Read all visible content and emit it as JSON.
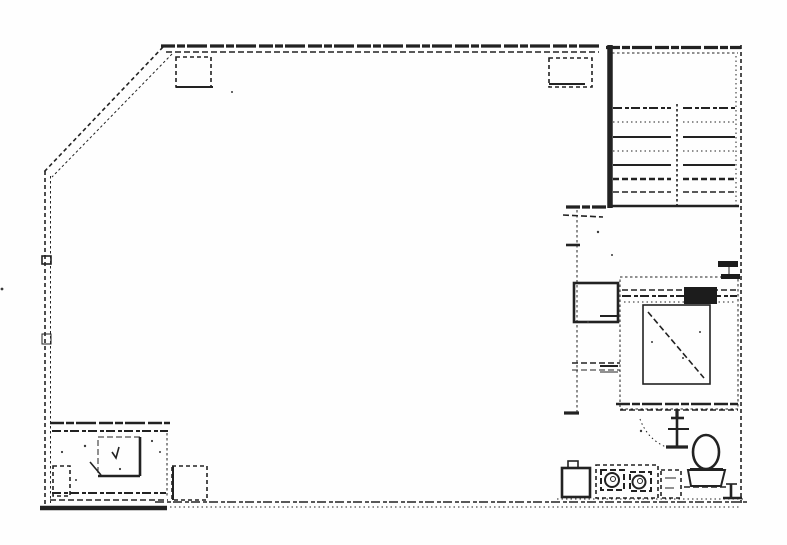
{
  "colors": {
    "ink": "#222222",
    "paper": "#fefefe"
  },
  "canvas": {
    "width": 787,
    "height": 545
  },
  "plan": {
    "elements": [
      {
        "name": "top-wall-outer",
        "t": "line",
        "x1": 161,
        "y1": 46,
        "x2": 601,
        "y2": 46,
        "cls": "w3 rough"
      },
      {
        "name": "top-wall-inner",
        "t": "line",
        "x1": 166,
        "y1": 52,
        "x2": 599,
        "y2": 52,
        "cls": "w15 dashA"
      },
      {
        "name": "chamfer-wall-outer",
        "t": "line",
        "x1": 163,
        "y1": 47,
        "x2": 44,
        "y2": 172,
        "cls": "w15 dashB"
      },
      {
        "name": "chamfer-wall-inner",
        "t": "line",
        "x1": 172,
        "y1": 54,
        "x2": 52,
        "y2": 177,
        "cls": "w1 dashC"
      },
      {
        "name": "left-wall-outer",
        "t": "line",
        "x1": 45,
        "y1": 171,
        "x2": 45,
        "y2": 509,
        "cls": "w15 dashB"
      },
      {
        "name": "left-wall-inner",
        "t": "line",
        "x1": 50.5,
        "y1": 176,
        "x2": 50.5,
        "y2": 503,
        "cls": "w1 dashC"
      },
      {
        "name": "left-wall-joint-upper",
        "t": "rect",
        "x": 42,
        "y": 256,
        "w": 9,
        "h": 8,
        "cls": "w15"
      },
      {
        "name": "left-wall-joint-lower",
        "t": "rect",
        "x": 42,
        "y": 334,
        "w": 9,
        "h": 10,
        "cls": "w1"
      },
      {
        "name": "bottom-wall-left-solid",
        "t": "line",
        "x1": 40,
        "y1": 508,
        "x2": 167,
        "y2": 508,
        "cls": "w4"
      },
      {
        "name": "bottom-wall-dashed",
        "t": "line",
        "x1": 155,
        "y1": 502,
        "x2": 748,
        "y2": 502,
        "cls": "w15 dashRough"
      },
      {
        "name": "bottom-wall-dotted",
        "t": "line",
        "x1": 170,
        "y1": 507,
        "x2": 740,
        "y2": 507,
        "cls": "w1 dotted"
      },
      {
        "name": "right-wall-dashed",
        "t": "line",
        "x1": 741,
        "y1": 45,
        "x2": 741,
        "y2": 503,
        "cls": "w15 dashB"
      },
      {
        "name": "stair-left-wall",
        "t": "line",
        "x1": 610,
        "y1": 45,
        "x2": 610,
        "y2": 208,
        "cls": "w5"
      },
      {
        "name": "stair-top-wall-outer",
        "t": "line",
        "x1": 606,
        "y1": 47.5,
        "x2": 741,
        "y2": 47.5,
        "cls": "w3 rough"
      },
      {
        "name": "stair-top-wall-inner",
        "t": "line",
        "x1": 612,
        "y1": 53,
        "x2": 738,
        "y2": 53,
        "cls": "w1 dashC"
      },
      {
        "name": "stair-right-inner-line",
        "t": "line",
        "x1": 736,
        "y1": 56,
        "x2": 736,
        "y2": 205,
        "cls": "w1 dotted"
      },
      {
        "name": "stair-bottom-wall",
        "t": "line",
        "x1": 608,
        "y1": 206,
        "x2": 739,
        "y2": 206,
        "cls": "w25"
      },
      {
        "name": "stair-center-divider",
        "t": "line",
        "x1": 677,
        "y1": 104,
        "x2": 677,
        "y2": 205,
        "cls": "w15 dashC"
      },
      {
        "name": "stair-tread",
        "t": "line",
        "x1": 613,
        "y1": 108,
        "x2": 671,
        "y2": 108,
        "cls": "w2 dashRough"
      },
      {
        "name": "stair-tread",
        "t": "line",
        "x1": 683,
        "y1": 108,
        "x2": 735,
        "y2": 108,
        "cls": "w2 dashRough"
      },
      {
        "name": "stair-tread",
        "t": "line",
        "x1": 613,
        "y1": 122,
        "x2": 671,
        "y2": 122,
        "cls": "w1 dotted"
      },
      {
        "name": "stair-tread",
        "t": "line",
        "x1": 683,
        "y1": 122,
        "x2": 735,
        "y2": 122,
        "cls": "w1 dotted"
      },
      {
        "name": "stair-tread",
        "t": "line",
        "x1": 613,
        "y1": 137,
        "x2": 671,
        "y2": 137,
        "cls": "w2"
      },
      {
        "name": "stair-tread",
        "t": "line",
        "x1": 683,
        "y1": 137,
        "x2": 735,
        "y2": 137,
        "cls": "w2"
      },
      {
        "name": "stair-tread",
        "t": "line",
        "x1": 613,
        "y1": 151,
        "x2": 671,
        "y2": 151,
        "cls": "w1 dotted"
      },
      {
        "name": "stair-tread",
        "t": "line",
        "x1": 683,
        "y1": 151,
        "x2": 735,
        "y2": 151,
        "cls": "w1 dotted"
      },
      {
        "name": "stair-tread",
        "t": "line",
        "x1": 613,
        "y1": 165,
        "x2": 671,
        "y2": 165,
        "cls": "w2"
      },
      {
        "name": "stair-tread",
        "t": "line",
        "x1": 683,
        "y1": 165,
        "x2": 735,
        "y2": 165,
        "cls": "w2"
      },
      {
        "name": "stair-tread",
        "t": "line",
        "x1": 613,
        "y1": 179,
        "x2": 671,
        "y2": 179,
        "cls": "w25 dashA"
      },
      {
        "name": "stair-tread",
        "t": "line",
        "x1": 683,
        "y1": 179,
        "x2": 735,
        "y2": 179,
        "cls": "w25 dashA"
      },
      {
        "name": "stair-tread",
        "t": "line",
        "x1": 613,
        "y1": 192,
        "x2": 671,
        "y2": 192,
        "cls": "w15 dashA"
      },
      {
        "name": "stair-tread",
        "t": "line",
        "x1": 683,
        "y1": 192,
        "x2": 735,
        "y2": 192,
        "cls": "w15 dashA"
      },
      {
        "name": "stair-landing-stub",
        "t": "line",
        "x1": 566,
        "y1": 207,
        "x2": 606,
        "y2": 207,
        "cls": "w3 rough"
      },
      {
        "name": "stair-landing-stub-lower",
        "t": "line",
        "x1": 563,
        "y1": 215,
        "x2": 603,
        "y2": 217,
        "cls": "w15 dashA"
      },
      {
        "name": "lobby-dashed-wall",
        "t": "line",
        "x1": 577,
        "y1": 210,
        "x2": 577,
        "y2": 414,
        "cls": "w1 dashC"
      },
      {
        "name": "lobby-wall-tick",
        "t": "line",
        "x1": 566,
        "y1": 245,
        "x2": 580,
        "y2": 245,
        "cls": "w25"
      },
      {
        "name": "lobby-wall-foot",
        "t": "line",
        "x1": 564,
        "y1": 413,
        "x2": 579,
        "y2": 413,
        "cls": "w3"
      },
      {
        "name": "column-top-left",
        "t": "rect",
        "x": 176,
        "y": 57,
        "w": 35,
        "h": 30,
        "cls": "w15 dashB"
      },
      {
        "name": "column-top-left-base",
        "t": "line",
        "x1": 176,
        "y1": 87,
        "x2": 213,
        "y2": 87,
        "cls": "w2"
      },
      {
        "name": "column-top-right",
        "t": "rect",
        "x": 549,
        "y": 58,
        "w": 43,
        "h": 29,
        "cls": "w15 dashB"
      },
      {
        "name": "column-top-right-base",
        "t": "line",
        "x1": 549,
        "y1": 84,
        "x2": 585,
        "y2": 84,
        "cls": "w2"
      },
      {
        "name": "column-bottom-middle",
        "t": "rect",
        "x": 172,
        "y": 466,
        "w": 35,
        "h": 34,
        "cls": "w15 dashB"
      },
      {
        "name": "column-bottom-middle-edge",
        "t": "line",
        "x1": 173,
        "y1": 466,
        "x2": 173,
        "y2": 500,
        "cls": "w2"
      },
      {
        "name": "utility-shaft-box",
        "t": "rect",
        "x": 574,
        "y": 283,
        "w": 44,
        "h": 39,
        "cls": "w25"
      },
      {
        "name": "elevator-shaft-outline",
        "t": "rect",
        "x": 620,
        "y": 277,
        "w": 118,
        "h": 132,
        "cls": "w1 dashC"
      },
      {
        "name": "elevator-door-line-1",
        "t": "line",
        "x1": 622,
        "y1": 290,
        "x2": 737,
        "y2": 290,
        "cls": "w15 dashA"
      },
      {
        "name": "elevator-door-line-2",
        "t": "line",
        "x1": 622,
        "y1": 296,
        "x2": 737,
        "y2": 296,
        "cls": "w2 dashRough"
      },
      {
        "name": "elevator-door-line-3",
        "t": "line",
        "x1": 624,
        "y1": 302,
        "x2": 735,
        "y2": 302,
        "cls": "w1 dotted"
      },
      {
        "name": "elevator-door-hatch",
        "t": "rect",
        "x": 684,
        "y": 287,
        "w": 33,
        "h": 17,
        "cls": "fillInk"
      },
      {
        "name": "wall-stub-upper",
        "t": "rect",
        "x": 718,
        "y": 261,
        "w": 20,
        "h": 6,
        "cls": "fillInk"
      },
      {
        "name": "wall-stub-lower",
        "t": "rect",
        "x": 721,
        "y": 274,
        "w": 19,
        "h": 5,
        "cls": "fillInk"
      },
      {
        "name": "wall-stub-tick",
        "t": "line",
        "x1": 729,
        "y1": 267,
        "x2": 729,
        "y2": 274,
        "cls": "w1"
      },
      {
        "name": "elevator-cab",
        "t": "rect",
        "x": 643,
        "y": 305,
        "w": 67,
        "h": 79,
        "cls": "w15"
      },
      {
        "name": "elevator-cab-diagonal",
        "t": "line",
        "x1": 648,
        "y1": 312,
        "x2": 704,
        "y2": 378,
        "cls": "w15 dashA"
      },
      {
        "name": "shaft-left-tick-1",
        "t": "line",
        "x1": 600,
        "y1": 316,
        "x2": 618,
        "y2": 316,
        "cls": "w2"
      },
      {
        "name": "shaft-left-tick-2",
        "t": "line",
        "x1": 600,
        "y1": 366,
        "x2": 618,
        "y2": 366,
        "cls": "w2"
      },
      {
        "name": "shaft-left-tick-3",
        "t": "line",
        "x1": 600,
        "y1": 372,
        "x2": 618,
        "y2": 372,
        "cls": "w1"
      },
      {
        "name": "shaft-bottom-wall-outer",
        "t": "line",
        "x1": 616,
        "y1": 404,
        "x2": 740,
        "y2": 404,
        "cls": "w25 rough"
      },
      {
        "name": "shaft-bottom-wall-inner",
        "t": "line",
        "x1": 620,
        "y1": 410,
        "x2": 738,
        "y2": 410,
        "cls": "w15 dashA"
      },
      {
        "name": "shaft-bottom-tick",
        "t": "line",
        "x1": 677,
        "y1": 409,
        "x2": 677,
        "y2": 419,
        "cls": "w3"
      },
      {
        "name": "shaft-bottom-tick-foot",
        "t": "line",
        "x1": 671,
        "y1": 418,
        "x2": 684,
        "y2": 418,
        "cls": "w25"
      },
      {
        "name": "lobby-hatch-line-1",
        "t": "line",
        "x1": 572,
        "y1": 363,
        "x2": 620,
        "y2": 363,
        "cls": "w15 dashA"
      },
      {
        "name": "lobby-hatch-line-2",
        "t": "line",
        "x1": 572,
        "y1": 370,
        "x2": 620,
        "y2": 370,
        "cls": "w1 dashA"
      },
      {
        "name": "restroom-door-jamb",
        "t": "line",
        "x1": 677,
        "y1": 413,
        "x2": 677,
        "y2": 448,
        "cls": "w25"
      },
      {
        "name": "restroom-jamb-tick",
        "t": "line",
        "x1": 668,
        "y1": 429,
        "x2": 689,
        "y2": 429,
        "cls": "w2"
      },
      {
        "name": "restroom-jamb-foot",
        "t": "line",
        "x1": 666,
        "y1": 447,
        "x2": 688,
        "y2": 447,
        "cls": "w3"
      },
      {
        "name": "door-swing-arc",
        "t": "path",
        "d": "M 640 419 Q 648 441 669 448",
        "cls": "w1 dotted"
      },
      {
        "name": "toilet-bowl",
        "t": "ellipse",
        "cx": 706,
        "cy": 452,
        "rx": 13,
        "ry": 17,
        "cls": "w25"
      },
      {
        "name": "toilet-seat-line",
        "t": "line",
        "x1": 690,
        "y1": 469,
        "x2": 723,
        "y2": 469,
        "cls": "w2"
      },
      {
        "name": "toilet-tank",
        "t": "path",
        "d": "M 688 470 L 725 470 L 721 486 L 691 486 Z",
        "cls": "w2"
      },
      {
        "name": "toilet-base-line",
        "t": "line",
        "x1": 684,
        "y1": 487,
        "x2": 727,
        "y2": 487,
        "cls": "w15 dashA"
      },
      {
        "name": "corner-pipe-vertical",
        "t": "line",
        "x1": 731,
        "y1": 484,
        "x2": 731,
        "y2": 499,
        "cls": "w25"
      },
      {
        "name": "corner-pipe-cap",
        "t": "line",
        "x1": 723,
        "y1": 498,
        "x2": 742,
        "y2": 498,
        "cls": "w25"
      },
      {
        "name": "corner-pipe-top-tick",
        "t": "line",
        "x1": 726,
        "y1": 484,
        "x2": 737,
        "y2": 484,
        "cls": "w15"
      },
      {
        "name": "vanity-counter",
        "t": "rect",
        "x": 596,
        "y": 465,
        "w": 62,
        "h": 33,
        "cls": "w15 dashB"
      },
      {
        "name": "sink-box-left",
        "t": "rect",
        "x": 601,
        "y": 470,
        "w": 23,
        "h": 20,
        "cls": "w2 dashA"
      },
      {
        "name": "sink-box-right",
        "t": "rect",
        "x": 630,
        "y": 472,
        "w": 21,
        "h": 19,
        "cls": "w2 dashA"
      },
      {
        "name": "sink-left-rim",
        "t": "circle",
        "cx": 612,
        "cy": 480,
        "r": 7,
        "cls": "w2"
      },
      {
        "name": "sink-left-drain",
        "t": "circle",
        "cx": 613,
        "cy": 479,
        "r": 2.5,
        "cls": "w1"
      },
      {
        "name": "sink-right-rim",
        "t": "circle",
        "cx": 639,
        "cy": 482,
        "r": 6.5,
        "cls": "w2"
      },
      {
        "name": "sink-right-drain",
        "t": "circle",
        "cx": 640,
        "cy": 481,
        "r": 2.5,
        "cls": "w1"
      },
      {
        "name": "mop-sink",
        "t": "rect",
        "x": 562,
        "y": 468,
        "w": 28,
        "h": 29,
        "cls": "w25"
      },
      {
        "name": "mop-sink-tab",
        "t": "rect",
        "x": 568,
        "y": 461,
        "w": 10,
        "h": 7,
        "cls": "w15"
      },
      {
        "name": "cabinet-right",
        "t": "rect",
        "x": 661,
        "y": 470,
        "w": 20,
        "h": 28,
        "cls": "w15 dashB"
      },
      {
        "name": "cabinet-right-mark-1",
        "t": "line",
        "x1": 665,
        "y1": 478,
        "x2": 676,
        "y2": 478,
        "cls": "w1"
      },
      {
        "name": "cabinet-right-mark-2",
        "t": "line",
        "x1": 665,
        "y1": 488,
        "x2": 674,
        "y2": 488,
        "cls": "w1"
      },
      {
        "name": "restroom-floor-line",
        "t": "line",
        "x1": 557,
        "y1": 499,
        "x2": 744,
        "y2": 499,
        "cls": "w1 dotted"
      },
      {
        "name": "machine-room-top-outer",
        "t": "line",
        "x1": 50,
        "y1": 423,
        "x2": 170,
        "y2": 423,
        "cls": "w25 rough"
      },
      {
        "name": "machine-room-top-inner",
        "t": "line",
        "x1": 52,
        "y1": 431,
        "x2": 168,
        "y2": 431,
        "cls": "w2 dashRough"
      },
      {
        "name": "machine-room-right-wall",
        "t": "line",
        "x1": 167,
        "y1": 433,
        "x2": 167,
        "y2": 497,
        "cls": "w1 dashC"
      },
      {
        "name": "machine-room-bottom-inner",
        "t": "line",
        "x1": 52,
        "y1": 493,
        "x2": 166,
        "y2": 493,
        "cls": "w2 dashRough"
      },
      {
        "name": "machine-room-bottom-outer",
        "t": "line",
        "x1": 50,
        "y1": 500,
        "x2": 168,
        "y2": 500,
        "cls": "w15 dashA"
      },
      {
        "name": "equipment-unit",
        "t": "rect",
        "x": 98,
        "y": 437,
        "w": 42,
        "h": 39,
        "cls": "w1 dashA"
      },
      {
        "name": "equipment-unit-right-edge",
        "t": "line",
        "x1": 140,
        "y1": 437,
        "x2": 140,
        "y2": 476,
        "cls": "w25"
      },
      {
        "name": "equipment-unit-bottom-edge",
        "t": "line",
        "x1": 98,
        "y1": 476,
        "x2": 140,
        "y2": 476,
        "cls": "w25"
      },
      {
        "name": "equipment-check-mark",
        "t": "polyline",
        "pts": "112,452 116,458 119,447",
        "cls": "w15"
      },
      {
        "name": "equipment-leader-line",
        "t": "line",
        "x1": 90,
        "y1": 462,
        "x2": 101,
        "y2": 475,
        "cls": "w15"
      },
      {
        "name": "small-cabinet",
        "t": "rect",
        "x": 53,
        "y": 466,
        "w": 17,
        "h": 30,
        "cls": "w15 dashB"
      },
      {
        "name": "scan-noise",
        "t": "dot",
        "cx": 2,
        "cy": 289,
        "r": 1.4
      },
      {
        "name": "scan-noise",
        "t": "dot",
        "cx": 85,
        "cy": 446,
        "r": 1.2
      },
      {
        "name": "scan-noise",
        "t": "dot",
        "cx": 120,
        "cy": 469,
        "r": 1.1
      },
      {
        "name": "scan-noise",
        "t": "dot",
        "cx": 62,
        "cy": 452,
        "r": 1.1
      },
      {
        "name": "scan-noise",
        "t": "dot",
        "cx": 152,
        "cy": 441,
        "r": 1.1
      },
      {
        "name": "scan-noise",
        "t": "dot",
        "cx": 76,
        "cy": 480,
        "r": 1.0
      },
      {
        "name": "scan-noise",
        "t": "dot",
        "cx": 232,
        "cy": 92,
        "r": 1.0
      },
      {
        "name": "scan-noise",
        "t": "dot",
        "cx": 598,
        "cy": 232,
        "r": 1.2
      },
      {
        "name": "scan-noise",
        "t": "dot",
        "cx": 588,
        "cy": 322,
        "r": 1.1
      },
      {
        "name": "scan-noise",
        "t": "dot",
        "cx": 652,
        "cy": 342,
        "r": 1.0
      },
      {
        "name": "scan-noise",
        "t": "dot",
        "cx": 683,
        "cy": 358,
        "r": 1.0
      },
      {
        "name": "scan-noise",
        "t": "dot",
        "cx": 700,
        "cy": 332,
        "r": 1.0
      },
      {
        "name": "scan-noise",
        "t": "dot",
        "cx": 641,
        "cy": 431,
        "r": 1.2
      },
      {
        "name": "scan-noise",
        "t": "dot",
        "cx": 612,
        "cy": 255,
        "r": 1.0
      },
      {
        "name": "scan-noise",
        "t": "dot",
        "cx": 160,
        "cy": 452,
        "r": 1.0
      }
    ]
  }
}
